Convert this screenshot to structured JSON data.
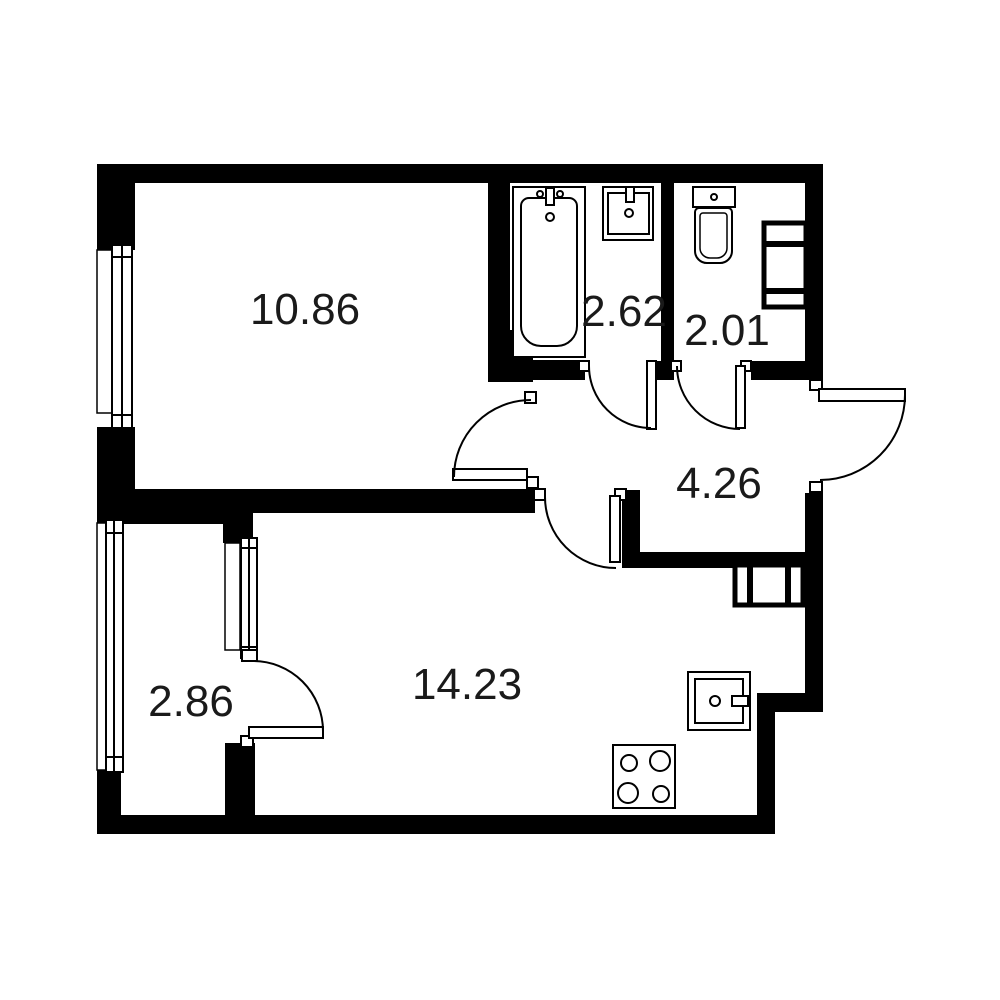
{
  "floor_plan": {
    "rooms": [
      {
        "id": "room-main",
        "area": "10.86"
      },
      {
        "id": "bathroom",
        "area": "2.62"
      },
      {
        "id": "toilet",
        "area": "2.01"
      },
      {
        "id": "hallway",
        "area": "4.26"
      },
      {
        "id": "balcony",
        "area": "2.86"
      },
      {
        "id": "kitchen-living",
        "area": "14.23"
      }
    ],
    "colors": {
      "wall": "#000000",
      "background": "#ffffff",
      "line": "#000000",
      "label_text": "#1a1a1a"
    }
  }
}
